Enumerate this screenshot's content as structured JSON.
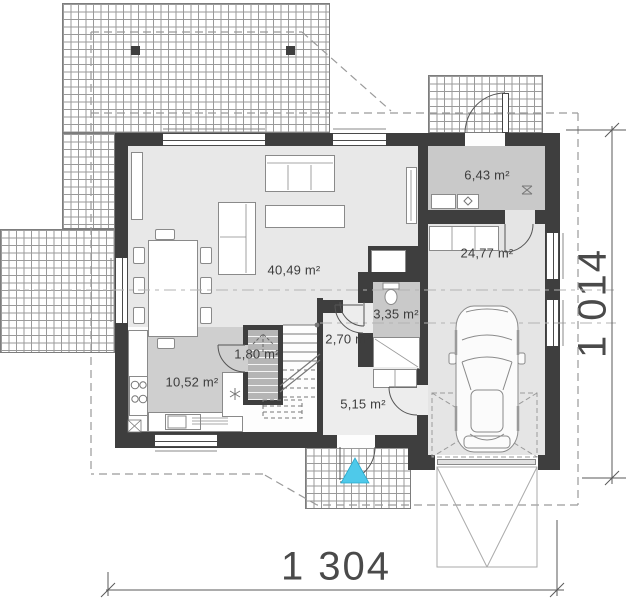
{
  "rooms": [
    {
      "id": "living-dining",
      "area_label": "40,49 m²"
    },
    {
      "id": "utility",
      "area_label": "6,43 m²"
    },
    {
      "id": "garage",
      "area_label": "24,77 m²"
    },
    {
      "id": "bathroom",
      "area_label": "3,35 m²"
    },
    {
      "id": "hall",
      "area_label": "2,70 m²"
    },
    {
      "id": "pantry",
      "area_label": "1,80 m²"
    },
    {
      "id": "kitchen",
      "area_label": "10,52 m²"
    },
    {
      "id": "entry",
      "area_label": "5,15 m²"
    }
  ],
  "dimensions": {
    "overall_width": "1 304",
    "overall_depth": "1 014"
  },
  "colors": {
    "wall": "#3e3e3e",
    "floor_light": "#e8e8e8",
    "floor_kitchen": "#cfcfcf",
    "floor_utility": "#c9c9c9",
    "pantry_fill": "#b5b5b5",
    "entrance_marker": "#4ec9ea"
  },
  "icons": {
    "entrance_marker": "cyan-triangle",
    "fridge": "snowflake-asterisk",
    "washer": "diamond",
    "floor_drain": "cross",
    "stairs_direction": "dashed-up-arrow",
    "car": "car-top-view"
  }
}
